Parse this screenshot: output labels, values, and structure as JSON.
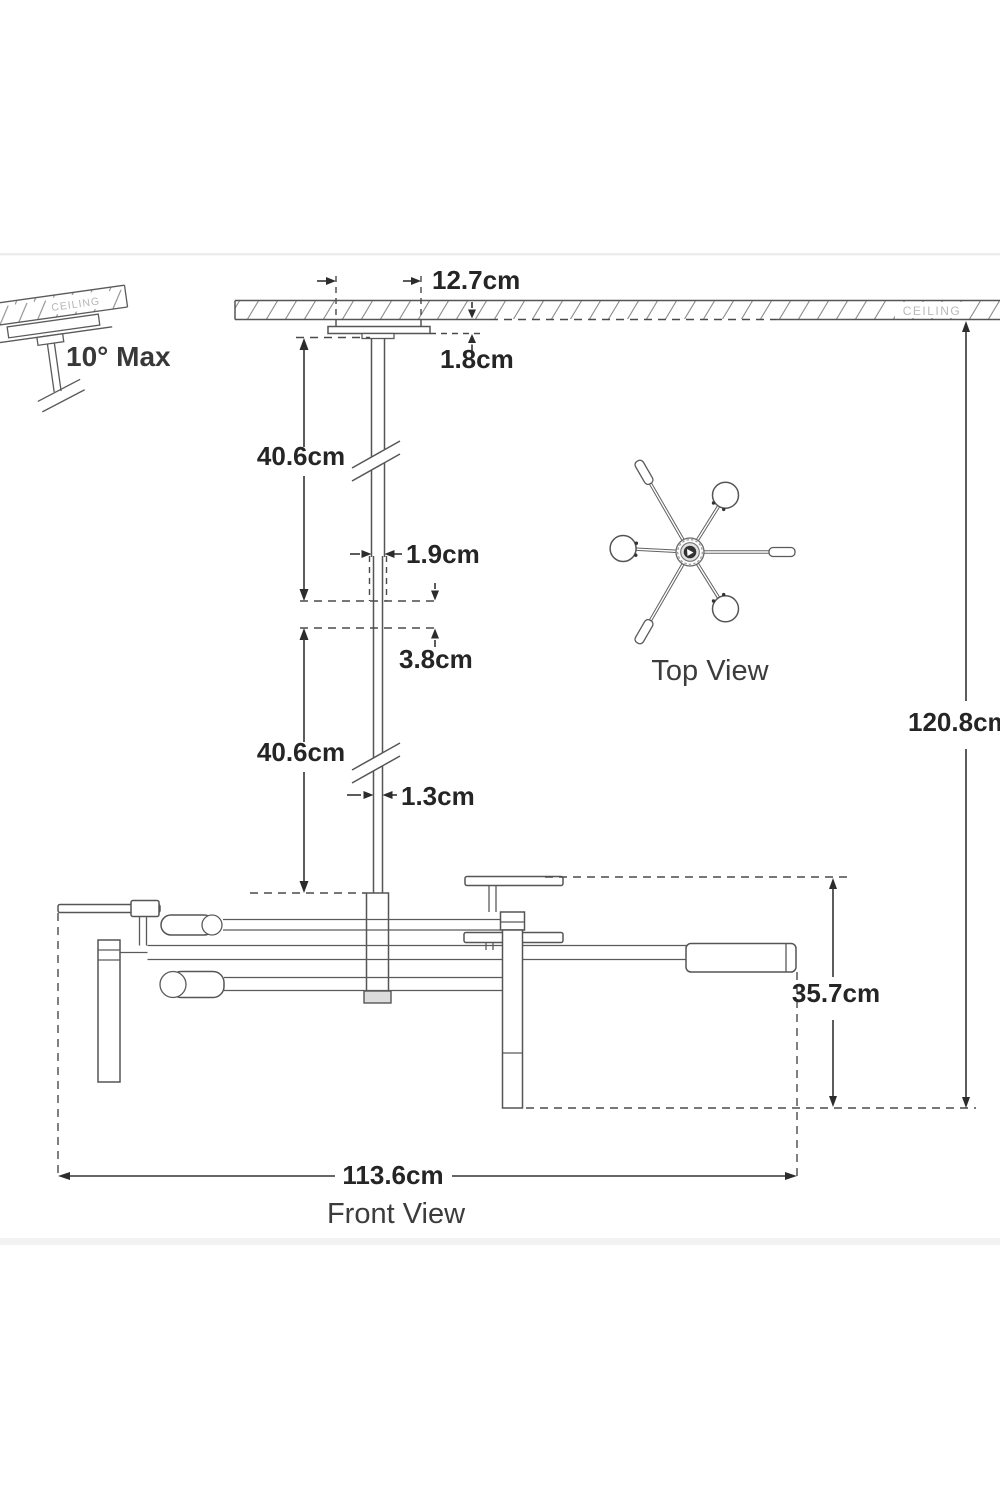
{
  "diagram": {
    "ceiling_label": "CEILING",
    "tilt_sketch": {
      "note": "10° Max",
      "ceiling_label": "CEILING"
    },
    "dims": {
      "canopy_width": "12.7cm",
      "canopy_height": "1.8cm",
      "upper_rod_length": "40.6cm",
      "upper_rod_width": "1.9cm",
      "rod_overlap": "3.8cm",
      "lower_rod_length": "40.6cm",
      "lower_rod_width": "1.3cm",
      "overall_height": "120.8cm",
      "body_height": "35.7cm",
      "overall_width": "113.6cm"
    },
    "labels": {
      "top_view": "Top View",
      "front_view": "Front View"
    }
  }
}
